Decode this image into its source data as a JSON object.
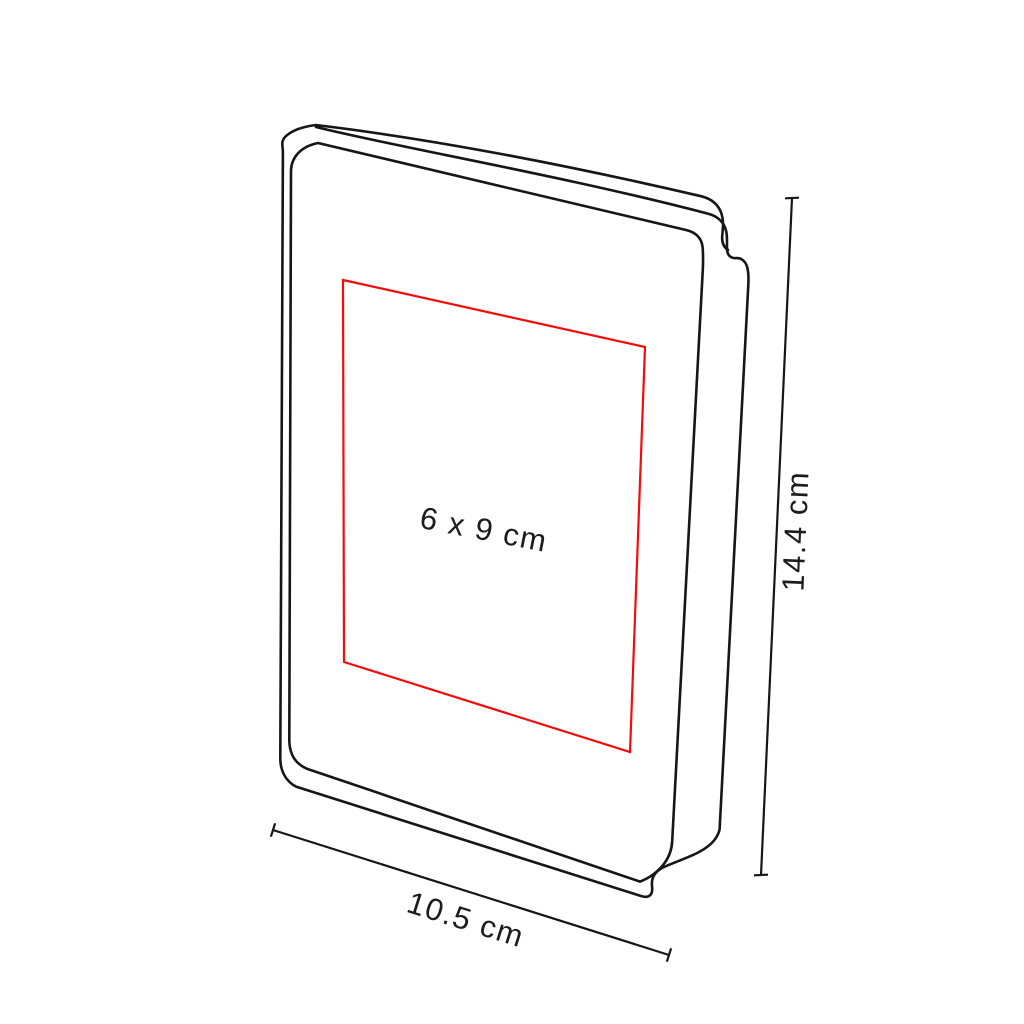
{
  "page": {
    "background": "#ffffff"
  },
  "diagram": {
    "type": "product-dimension-diagram",
    "subject": "notebook line drawing in three-quarter perspective",
    "labels": {
      "print_area": "6 x 9 cm",
      "width": "10.5 cm",
      "height": "14.4 cm"
    },
    "colors": {
      "outline": "#161616",
      "print_area": "#f40b0b",
      "dimension_lines": "#161616",
      "text": "#1c1c1c",
      "background": "#ffffff"
    }
  }
}
